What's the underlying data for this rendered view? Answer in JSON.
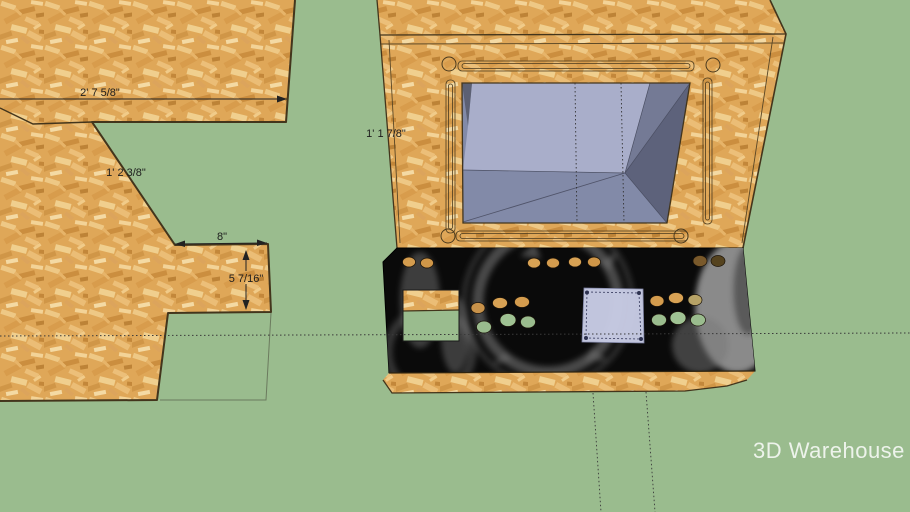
{
  "viewport": {
    "app_context": "3D model viewport",
    "watermark": {
      "label": "3D Warehouse"
    }
  },
  "dimensions": {
    "width_top": "2' 7 5/8\"",
    "diagonal": "1' 2 3/8\"",
    "notch_width": "8\"",
    "step_height": "5 7/16\"",
    "cabinet_height": "1' 1 7/8\""
  },
  "colors": {
    "background": "#9abc8e",
    "wood_base": "#dfa758",
    "wood_edge": "#43351c",
    "panel_top": "#0a0a0a",
    "plate": "#c9cde6",
    "screen_light": "#a9aeca",
    "screen_floor": "#828aa8",
    "screen_right_upper": "#747a95",
    "screen_right_lower": "#5d627b",
    "screen_left_sliver": "#5c6073",
    "hole_wood": "#d49c4e",
    "hole_dark": "#79592b",
    "hole_green": "#9abc8e"
  },
  "counts": {
    "button_holes_top_row": 8,
    "button_holes_left_cluster": 6,
    "button_holes_right_cluster": 6
  }
}
